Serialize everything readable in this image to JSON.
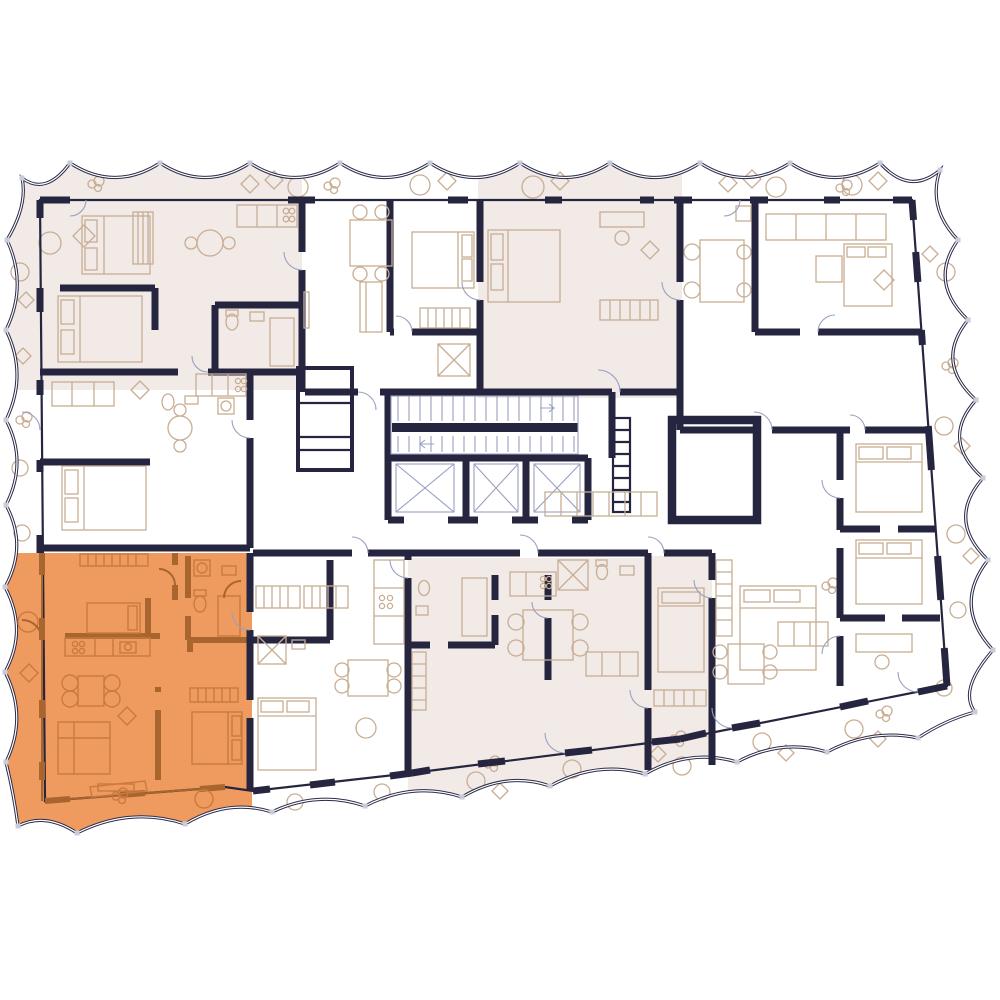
{
  "colors": {
    "background": "#ffffff",
    "wall": "#26253f",
    "balcony_outline": "#2b2a49",
    "shade": "#f1eae6",
    "accent_orange": "#ef9a5e",
    "orange_wall": "#a8662e",
    "orange_furniture": "#c97b3e",
    "furniture": "#c8ad93",
    "thin_line": "#9aa0c0",
    "tick": "#c9ccd8"
  },
  "floor_plan": {
    "type": "residential-floor-plan",
    "highlighted_unit": "bottom-left-apartment",
    "highlighted_color_key": "accent_orange",
    "shaded_units": [
      "top-left",
      "top-center-right",
      "bottom-center",
      "bottom-center-right-strip"
    ],
    "core": {
      "elevator_count": 3,
      "stair_flights": 2
    },
    "balconies": "scalloped-perimeter"
  }
}
